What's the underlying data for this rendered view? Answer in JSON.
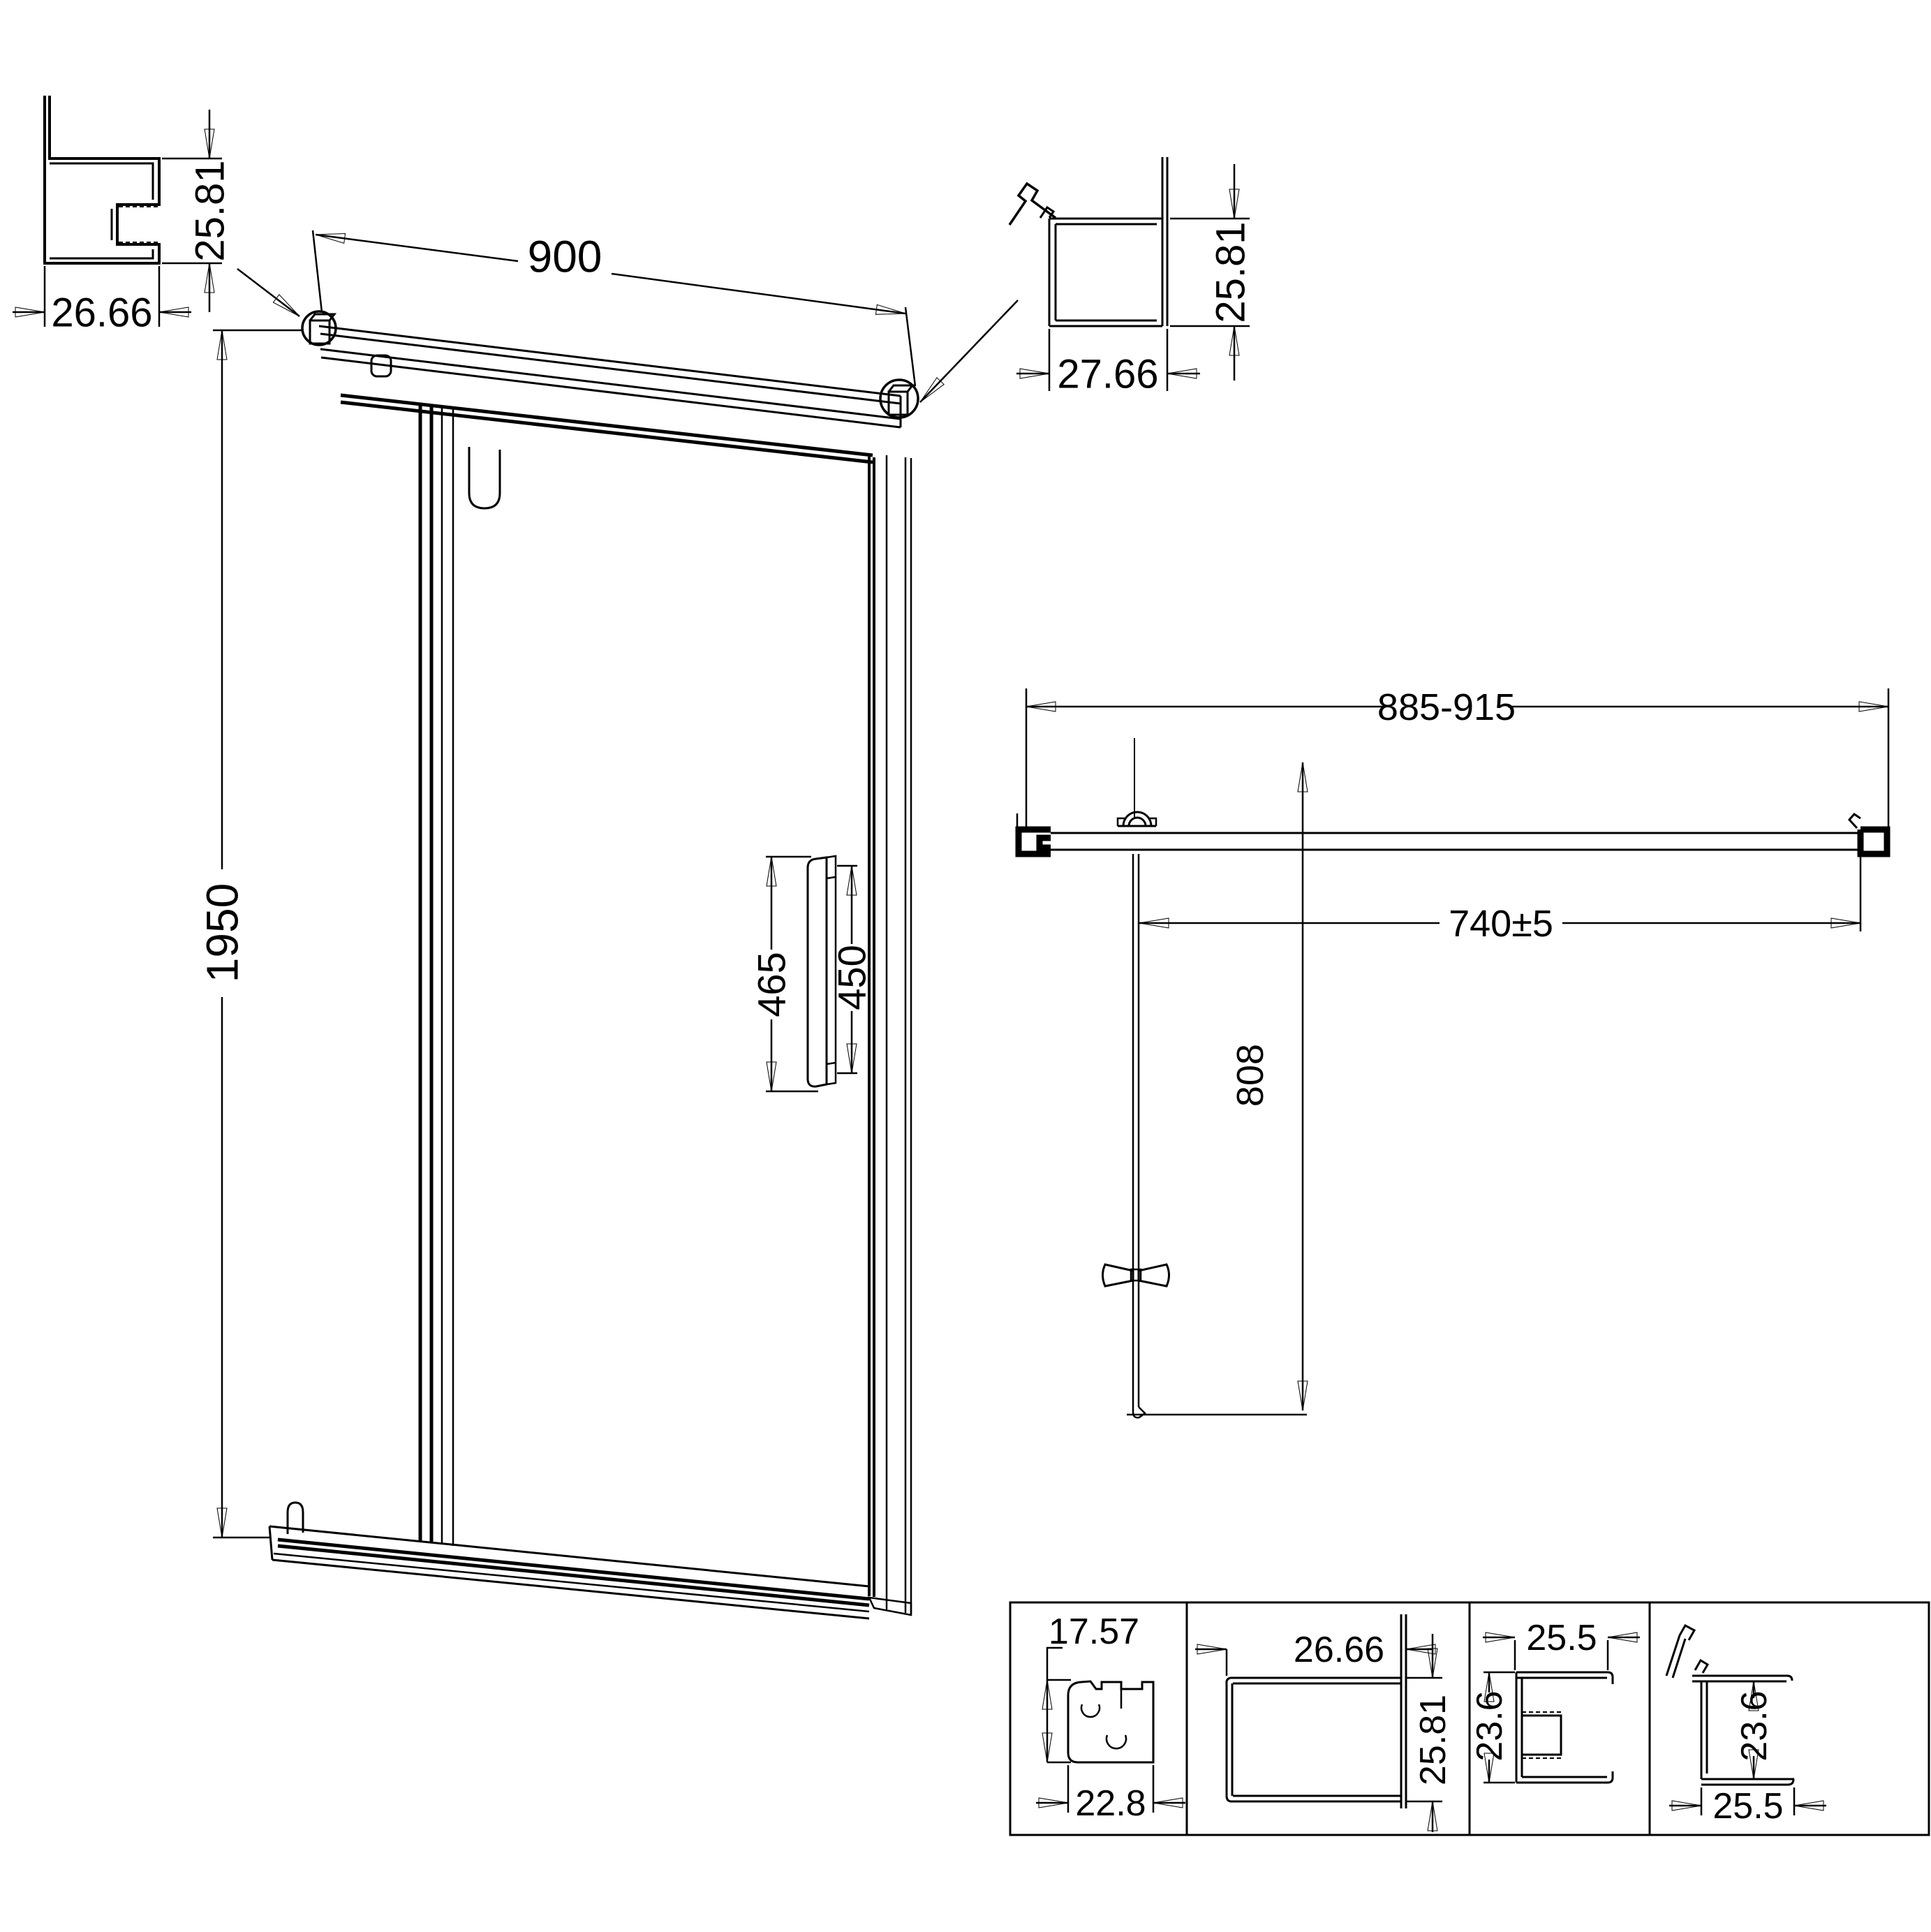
{
  "page": {
    "background": "#ffffff",
    "line_color": "#000000"
  },
  "elevation": {
    "door_width": "900",
    "door_height": "1950",
    "handle_length_outer": "465",
    "handle_length_inner": "450"
  },
  "wall_profile_left": {
    "width": "26.66",
    "height": "25.81"
  },
  "wall_profile_right": {
    "width": "27.66",
    "height": "25.81"
  },
  "plan": {
    "adjustment_range": "885-915",
    "door_leaf_width": "740±5",
    "swing_clearance": "808"
  },
  "profile_details": [
    {
      "dim_top": "17.57",
      "dim_bottom": "22.8"
    },
    {
      "dim_top": "26.66",
      "dim_side": "25.81"
    },
    {
      "dim_top": "25.5",
      "dim_side": "23.6"
    },
    {
      "dim_side": "23.6",
      "dim_bottom": "25.5"
    }
  ]
}
